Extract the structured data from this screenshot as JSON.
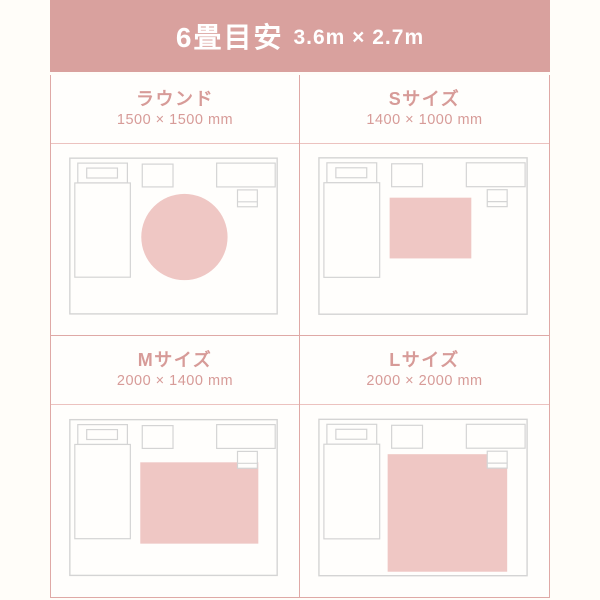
{
  "header": {
    "title": "6畳目安",
    "subtitle": "3.6m × 2.7m"
  },
  "colors": {
    "page_bg": "#fffdf9",
    "panel_bg": "#fffefc",
    "header_bg": "#d9a19e",
    "header_text": "#ffffff",
    "grid_border": "#dfa9a6",
    "head_separator": "#ecc2bf",
    "label_text": "#d79b98",
    "rug_fill": "#efc7c4",
    "furniture_stroke": "#d4d4d4"
  },
  "options": [
    {
      "name": "ラウンド",
      "size": "1500 × 1500 mm",
      "rug": {
        "shape": "circle",
        "cx": 134.5,
        "cy": 92.5,
        "r": 43.5
      }
    },
    {
      "name": "Sサイズ",
      "size": "1400 × 1000 mm",
      "rug": {
        "shape": "rect",
        "x": 90,
        "y": 53,
        "w": 82,
        "h": 61
      }
    },
    {
      "name": "Mサイズ",
      "size": "2000 × 1400 mm",
      "rug": {
        "shape": "rect",
        "x": 90,
        "y": 56,
        "w": 119,
        "h": 82
      }
    },
    {
      "name": "Lサイズ",
      "size": "2000 × 2000 mm",
      "rug": {
        "shape": "rect",
        "x": 88,
        "y": 48,
        "w": 120,
        "h": 118
      }
    }
  ],
  "room_diagram": {
    "viewbox": "0 0 250 190",
    "room": {
      "x": 19,
      "y": 13,
      "w": 209,
      "h": 157
    },
    "furniture": [
      {
        "name": "bed-headboard",
        "x": 27,
        "y": 18,
        "w": 50,
        "h": 20
      },
      {
        "name": "bed-body",
        "x": 24,
        "y": 38,
        "w": 56,
        "h": 95
      },
      {
        "name": "pillow",
        "x": 36,
        "y": 23,
        "w": 31,
        "h": 10
      },
      {
        "name": "side-table",
        "x": 92,
        "y": 19,
        "w": 31,
        "h": 23
      },
      {
        "name": "desk",
        "x": 167,
        "y": 18,
        "w": 59,
        "h": 24
      },
      {
        "name": "chair",
        "x": 188,
        "y": 45,
        "w": 20,
        "h": 17,
        "line_y": 57
      }
    ]
  }
}
